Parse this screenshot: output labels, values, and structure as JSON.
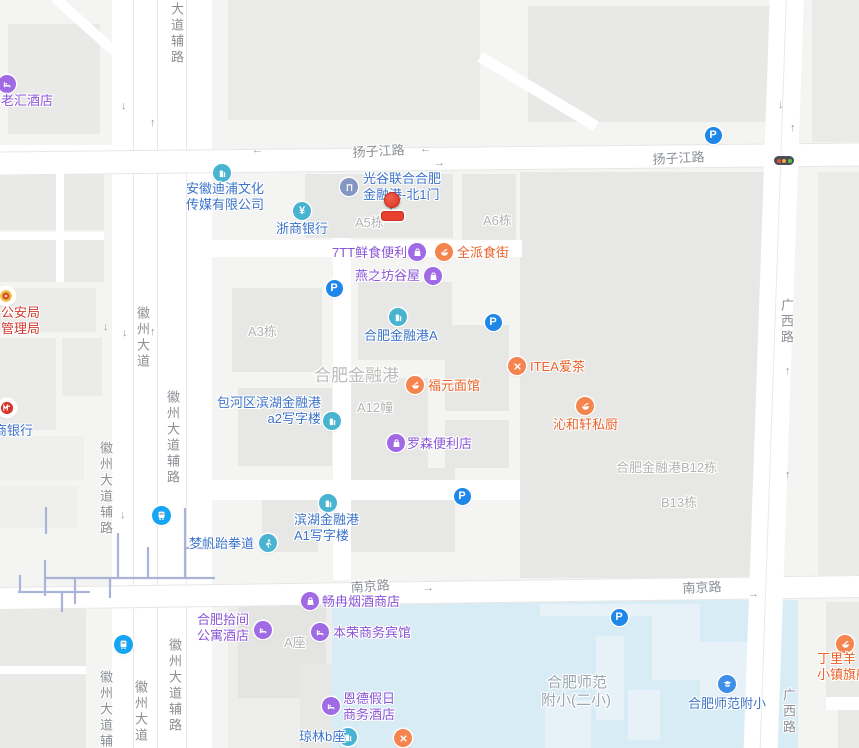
{
  "map": {
    "palette": {
      "poi_purple_text": "#8a55d6",
      "poi_purple_icon": "#a06ae4",
      "poi_blue_text": "#3c73c9",
      "poi_teal_icon": "#49b4d2",
      "poi_orange_text": "#e8622a",
      "poi_orange_icon": "#f5854f",
      "poi_red_text": "#ce3a2e",
      "parking_icon": "#1f87e8",
      "bus_icon": "#15a5f2",
      "water": "#d8ecf5",
      "marker_red": "#e8402f"
    },
    "marker": {
      "x": 391,
      "y": 199
    },
    "road_labels": [
      {
        "t": "大道辅路",
        "x": 167,
        "y": 2,
        "v": 1
      },
      {
        "t": "扬子江路",
        "x": 352,
        "y": 142,
        "r": -3
      },
      {
        "t": "扬子江路",
        "x": 652,
        "y": 149,
        "r": -3
      },
      {
        "t": "徽州大道",
        "x": 133,
        "y": 306,
        "v": 1
      },
      {
        "t": "徽州大道辅路",
        "x": 163,
        "y": 390,
        "v": 1
      },
      {
        "t": "徽州大道辅路",
        "x": 96,
        "y": 441,
        "v": 1
      },
      {
        "t": "南京路",
        "x": 350,
        "y": 577,
        "r": -4
      },
      {
        "t": "南京路",
        "x": 682,
        "y": 578,
        "r": -3
      },
      {
        "t": "徽州大道辅路",
        "x": 96,
        "y": 670,
        "v": 1
      },
      {
        "t": "徽州大道",
        "x": 131,
        "y": 680,
        "v": 1
      },
      {
        "t": "徽州大道辅路",
        "x": 165,
        "y": 638,
        "v": 1
      },
      {
        "t": "广西路",
        "x": 777,
        "y": 298,
        "v": 1
      },
      {
        "t": "广西路",
        "x": 779,
        "y": 688,
        "v": 1
      }
    ],
    "area_labels": [
      {
        "t": "A5栋",
        "x": 355,
        "y": 212
      },
      {
        "t": "A6栋",
        "x": 483,
        "y": 210
      },
      {
        "t": "A3栋",
        "x": 248,
        "y": 321
      },
      {
        "t": "合肥金融港",
        "x": 314,
        "y": 361,
        "s": 17,
        "c": "#bcbcba"
      },
      {
        "t": "A12幢",
        "x": 357,
        "y": 397
      },
      {
        "t": "合肥金融港B12栋",
        "x": 616,
        "y": 457
      },
      {
        "t": "B13栋",
        "x": 661,
        "y": 492
      },
      {
        "t": "A座",
        "x": 284,
        "y": 632
      },
      {
        "t": "合肥师范",
        "x": 547,
        "y": 671,
        "s": 15,
        "c": "#9aa6b2"
      },
      {
        "t": "附小(二小)",
        "x": 541,
        "y": 689,
        "s": 15,
        "c": "#9aa6b2"
      }
    ],
    "arrows": [
      {
        "d": "↓",
        "x": 121,
        "y": 100
      },
      {
        "d": "↑",
        "x": 150,
        "y": 117
      },
      {
        "d": "←",
        "x": 252,
        "y": 144
      },
      {
        "d": "←",
        "x": 420,
        "y": 143
      },
      {
        "d": "→",
        "x": 434,
        "y": 157
      },
      {
        "d": "↓",
        "x": 103,
        "y": 321
      },
      {
        "d": "↓",
        "x": 122,
        "y": 327
      },
      {
        "d": "↑",
        "x": 150,
        "y": 326
      },
      {
        "d": "↓",
        "x": 120,
        "y": 509
      },
      {
        "d": "↓",
        "x": 778,
        "y": 99
      },
      {
        "d": "↑",
        "x": 790,
        "y": 122
      },
      {
        "d": "↑",
        "x": 785,
        "y": 365
      },
      {
        "d": "↑",
        "x": 785,
        "y": 469
      },
      {
        "d": "→",
        "x": 423,
        "y": 582
      },
      {
        "d": "→",
        "x": 748,
        "y": 588
      }
    ],
    "transit": [
      {
        "icon": "parking-icon",
        "x": 334,
        "y": 288
      },
      {
        "icon": "parking-icon",
        "x": 493,
        "y": 322
      },
      {
        "icon": "parking-icon",
        "x": 462,
        "y": 496
      },
      {
        "icon": "parking-icon",
        "x": 619,
        "y": 617
      },
      {
        "icon": "parking-icon",
        "x": 713,
        "y": 135
      },
      {
        "icon": "bus-icon",
        "x": 161,
        "y": 515
      },
      {
        "icon": "bus-icon",
        "x": 123,
        "y": 644
      },
      {
        "icon": "traffic-light-icon",
        "x": 784,
        "y": 161
      }
    ],
    "pois": [
      {
        "icon": "hotel-icon",
        "cat": "purple",
        "x": 7,
        "y": 84,
        "lines": [
          "老汇酒店"
        ],
        "lx": 1,
        "ly": 93,
        "align": "left"
      },
      {
        "icon": "building-icon",
        "cat": "blue",
        "x": 222,
        "y": 173,
        "lines": [
          "安徽迪浦文化",
          "传媒有限公司"
        ],
        "lx": 186,
        "ly": 181,
        "align": "left"
      },
      {
        "icon": "yen-icon",
        "cat": "blue",
        "x": 302,
        "y": 211,
        "lines": [
          "浙商银行"
        ],
        "lx": 276,
        "ly": 221,
        "align": "left"
      },
      {
        "icon": "door-icon",
        "cat": "blue",
        "ibg": "#8496c2",
        "x": 349,
        "y": 187,
        "lines": [
          "光谷联合合肥",
          "金融港-北1门"
        ],
        "lx": 363,
        "ly": 171,
        "align": "left"
      },
      {
        "icon": "building-icon",
        "cat": "blue",
        "x": 398,
        "y": 317,
        "lines": [
          "合肥金融港A"
        ],
        "lx": 364,
        "ly": 328,
        "align": "left"
      },
      {
        "icon": "building-icon",
        "cat": "blue",
        "x": 332,
        "y": 421,
        "lines": [
          "包河区滨湖金融港",
          "a2写字楼"
        ],
        "lx": 321,
        "ly": 395,
        "align": "right"
      },
      {
        "icon": "building-icon",
        "cat": "blue",
        "x": 328,
        "y": 503,
        "lines": [
          "滨湖金融港",
          "A1写字楼"
        ],
        "lx": 294,
        "ly": 512,
        "align": "left"
      },
      {
        "icon": "person-icon",
        "cat": "blue",
        "x": 268,
        "y": 543,
        "lines": [
          "梦帆跆拳道"
        ],
        "lx": 189,
        "ly": 536,
        "align": "left"
      },
      {
        "icon": "building-icon",
        "cat": "blue",
        "x": 348,
        "y": 737,
        "lines": [
          "琼林b座"
        ],
        "lx": 299,
        "ly": 729,
        "align": "left"
      },
      {
        "icon": "school-icon",
        "cat": "blue",
        "ibg": "#3d8fe8",
        "x": 727,
        "y": 684,
        "lines": [
          "合肥师范附小"
        ],
        "lx": 688,
        "ly": 696,
        "align": "left"
      },
      {
        "icon": "cmb-bank-icon",
        "cat": "blue",
        "ibg": "#fff",
        "x": 7,
        "y": 408,
        "lines": [
          "商银行"
        ],
        "lx": -6,
        "ly": 423,
        "align": "left"
      },
      {
        "icon": "police-badge-icon",
        "cat": "red",
        "ibg": "#fff",
        "x": 6,
        "y": 296,
        "lines": [
          "公安局",
          "管理局"
        ],
        "lx": 1,
        "ly": 305,
        "align": "left"
      },
      {
        "icon": "bag-icon",
        "cat": "purple",
        "x": 417,
        "y": 252,
        "lines": [
          "7TT鲜食便利"
        ],
        "lx": 332,
        "ly": 245,
        "align": "left"
      },
      {
        "icon": "bag-icon",
        "cat": "purple",
        "x": 433,
        "y": 276,
        "lines": [
          "燕之坊谷屋"
        ],
        "lx": 355,
        "ly": 268,
        "align": "left"
      },
      {
        "icon": "bag-icon",
        "cat": "purple",
        "x": 396,
        "y": 443,
        "lines": [
          "罗森便利店"
        ],
        "lx": 407,
        "ly": 436,
        "align": "left"
      },
      {
        "icon": "bag-icon",
        "cat": "purple",
        "x": 310,
        "y": 601,
        "lines": [
          "畅冉烟酒商店"
        ],
        "lx": 322,
        "ly": 594,
        "align": "left"
      },
      {
        "icon": "hotel-icon",
        "cat": "purple",
        "x": 263,
        "y": 630,
        "lines": [
          "合肥拾间",
          "公寓酒店"
        ],
        "lx": 249,
        "ly": 612,
        "align": "right"
      },
      {
        "icon": "hotel-icon",
        "cat": "purple",
        "x": 320,
        "y": 632,
        "lines": [
          "本荣商务宾馆"
        ],
        "lx": 333,
        "ly": 625,
        "align": "left"
      },
      {
        "icon": "hotel-icon",
        "cat": "purple",
        "x": 331,
        "y": 706,
        "lines": [
          "恩德假日",
          "商务酒店"
        ],
        "lx": 343,
        "ly": 691,
        "align": "left"
      },
      {
        "icon": "food-icon",
        "cat": "orange",
        "x": 444,
        "y": 252,
        "lines": [
          "全派食街"
        ],
        "lx": 457,
        "ly": 245,
        "align": "left"
      },
      {
        "icon": "utensils-icon",
        "cat": "orange",
        "x": 517,
        "y": 366,
        "lines": [
          "ITEA爱茶"
        ],
        "lx": 530,
        "ly": 359,
        "align": "left"
      },
      {
        "icon": "food-icon",
        "cat": "orange",
        "x": 415,
        "y": 385,
        "lines": [
          "福元面馆"
        ],
        "lx": 428,
        "ly": 378,
        "align": "left"
      },
      {
        "icon": "food-icon",
        "cat": "orange",
        "x": 585,
        "y": 406,
        "lines": [
          "沁和轩私厨"
        ],
        "lx": 553,
        "ly": 417,
        "align": "left"
      },
      {
        "icon": "food-icon",
        "cat": "orange",
        "x": 845,
        "y": 644,
        "lines": [
          "丁里羊",
          "小镇旗舰"
        ],
        "lx": 817,
        "ly": 651,
        "align": "left"
      },
      {
        "icon": "utensils-icon",
        "cat": "orange",
        "x": 403,
        "y": 738,
        "lines": [],
        "lx": 0,
        "ly": 0,
        "align": "left"
      }
    ]
  }
}
